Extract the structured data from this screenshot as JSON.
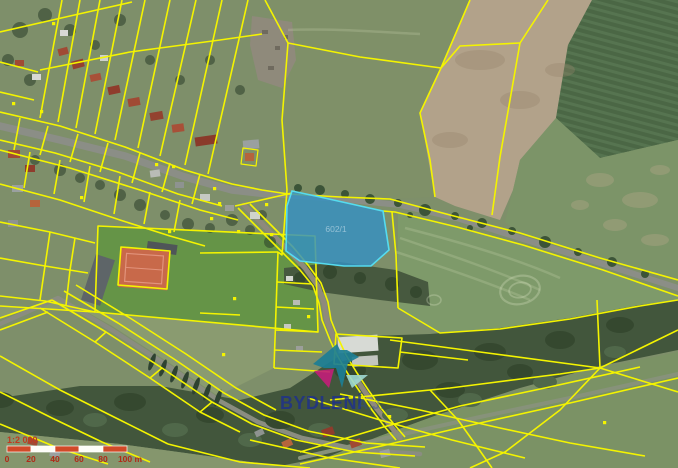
{
  "map": {
    "parcel_label": "602/1",
    "watermark": {
      "brand": "BYDLENÍ",
      "suffix": "A.J."
    },
    "scale_bar": {
      "ratio": "1:2 000",
      "ticks": [
        "0",
        "20",
        "40",
        "60",
        "80",
        "100 m"
      ]
    },
    "colors": {
      "cadastral_line": "#f4f400",
      "highlight_fill": "#3490c2",
      "highlight_stroke": "#55dcef",
      "scale_red": "#d14a28",
      "scale_text": "#b02a18",
      "watermark_blue": "#1d2f8e"
    }
  }
}
